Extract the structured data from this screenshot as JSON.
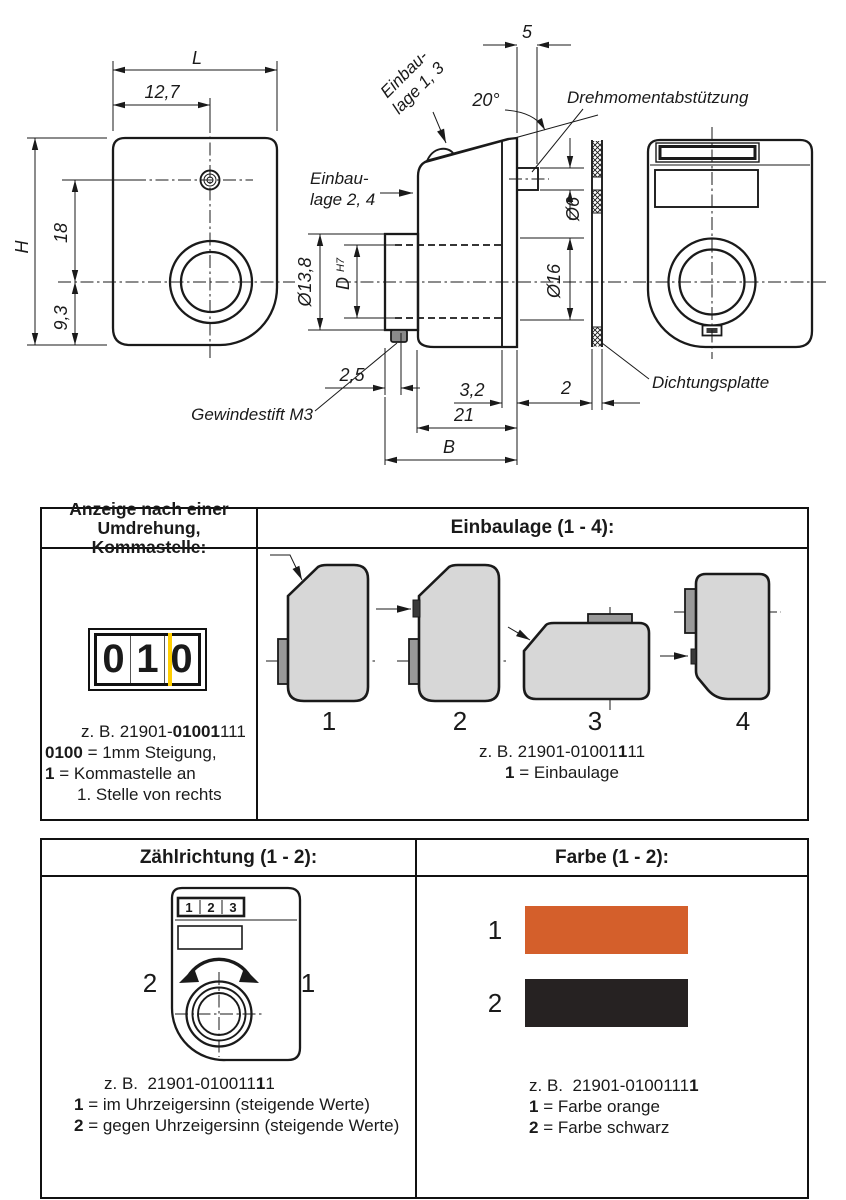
{
  "drawing": {
    "dims": {
      "L": "L",
      "offset": "12,7",
      "H": "H",
      "h18": "18",
      "h93": "9,3",
      "pin_len": "5",
      "angle": "20°",
      "pin_dia": "Ø6",
      "hole_dia": "Ø16",
      "hub_dia": "Ø13,8",
      "bore": "D",
      "bore_tol": "H7",
      "set_pos": "2,5",
      "flange": "3,2",
      "depth": "21",
      "depth_total": "B",
      "plate_t": "2"
    },
    "labels": {
      "install13_l1": "Einbau-",
      "install13_l2": "lage 1, 3",
      "install24_l1": "Einbau-",
      "install24_l2": "lage 2, 4",
      "torque": "Drehmomentabstützung",
      "seal": "Dichtungsplatte",
      "setscrew": "Gewindestift M3"
    }
  },
  "tables": {
    "anzeige": {
      "header_line1": "Anzeige nach einer",
      "header_line2": "Umdrehung, Kommastelle:",
      "counter_digits": [
        "0",
        "1",
        "0"
      ],
      "example": {
        "pre": "z. B. 21901-",
        "bold": "01001",
        "post": "111"
      },
      "legend": [
        {
          "key": "0100",
          "text": "= 1mm Steigung,"
        },
        {
          "key": "1",
          "text": "= Kommastelle an"
        },
        {
          "key": "",
          "text": "1. Stelle von rechts"
        }
      ]
    },
    "einbaulage": {
      "header": "Einbaulage (1 - 4):",
      "positions": [
        "1",
        "2",
        "3",
        "4"
      ],
      "example": {
        "pre": "z. B. 21901-01001",
        "bold": "1",
        "post": "11"
      },
      "legend": [
        {
          "key": "1",
          "text": "= Einbaulage"
        }
      ]
    },
    "zaehlrichtung": {
      "header": "Zählrichtung (1 - 2):",
      "display_digits": [
        "1",
        "2",
        "3"
      ],
      "left_num": "2",
      "right_num": "1",
      "example": {
        "pre": "z. B.  21901-010011",
        "bold": "1",
        "post": "1"
      },
      "legend": [
        {
          "key": "1",
          "text": "= im Uhrzeigersinn (steigende Werte)"
        },
        {
          "key": "2",
          "text": "= gegen Uhrzeigersinn (steigende Werte)"
        }
      ]
    },
    "farbe": {
      "header": "Farbe (1 - 2):",
      "swatches": [
        {
          "num": "1",
          "color": "#d45f2b"
        },
        {
          "num": "2",
          "color": "#262222"
        }
      ],
      "example": {
        "pre": "z. B.  21901-0100111",
        "bold": "1",
        "post": ""
      },
      "legend": [
        {
          "key": "1",
          "text": "= Farbe orange"
        },
        {
          "key": "2",
          "text": "= Farbe schwarz"
        }
      ]
    }
  },
  "colors": {
    "line": "#1a1a1a",
    "orange": "#d45f2b",
    "swatch_black": "#262222",
    "comma_marker": "#ffce00",
    "shape_fill": "#d7d7d7",
    "hub_fill": "#999999"
  }
}
